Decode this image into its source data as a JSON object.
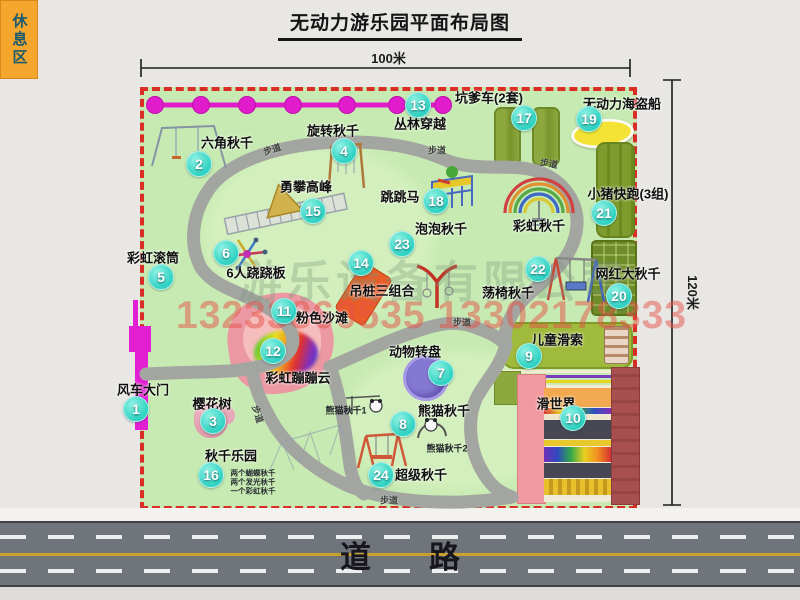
{
  "title": "无动力游乐园平面布局图",
  "dimensions": {
    "width_label": "100米",
    "height_label": "120米"
  },
  "road": {
    "label": "道路"
  },
  "watermark": {
    "company": "游乐设备有限公司",
    "phone": "13233860535 13302178333"
  },
  "rest_area": {
    "label": "休息区"
  },
  "walkway_label": "步道",
  "rainbow_swing_label": "彩虹秋千",
  "panda_sub_labels": [
    "熊猫秋千1",
    "熊猫秋千2"
  ],
  "swing_park_sublines": [
    "两个蝴蝶秋千",
    "两个发光秋千",
    "一个彩虹秋千"
  ],
  "attractions": [
    {
      "num": "1",
      "label": "风车大门",
      "bx": 135,
      "by": 408,
      "lx": 143,
      "ly": 389
    },
    {
      "num": "2",
      "label": "六角秋千",
      "bx": 198,
      "by": 163,
      "lx": 227,
      "ly": 142
    },
    {
      "num": "3",
      "label": "樱花树",
      "bx": 212,
      "by": 420,
      "lx": 212,
      "ly": 403
    },
    {
      "num": "4",
      "label": "旋转秋千",
      "bx": 343,
      "by": 150,
      "lx": 333,
      "ly": 130
    },
    {
      "num": "5",
      "label": "彩虹滚筒",
      "bx": 160,
      "by": 276,
      "lx": 153,
      "ly": 257
    },
    {
      "num": "6",
      "label": "6人跷跷板",
      "bx": 225,
      "by": 252,
      "lx": 256,
      "ly": 272
    },
    {
      "num": "7",
      "label": "动物转盘",
      "bx": 440,
      "by": 372,
      "lx": 415,
      "ly": 351
    },
    {
      "num": "8",
      "label": "熊猫秋千",
      "bx": 402,
      "by": 423,
      "lx": 444,
      "ly": 410
    },
    {
      "num": "9",
      "label": "儿童滑索",
      "bx": 528,
      "by": 355,
      "lx": 557,
      "ly": 339
    },
    {
      "num": "10",
      "label": "滑世界",
      "bx": 572,
      "by": 417,
      "lx": 556,
      "ly": 403
    },
    {
      "num": "11",
      "label": "粉色沙滩",
      "bx": 283,
      "by": 310,
      "lx": 322,
      "ly": 317
    },
    {
      "num": "12",
      "label": "彩虹蹦蹦云",
      "bx": 272,
      "by": 350,
      "lx": 298,
      "ly": 377
    },
    {
      "num": "13",
      "label": "丛林穿越",
      "bx": 417,
      "by": 104,
      "lx": 420,
      "ly": 123
    },
    {
      "num": "14",
      "label": "吊桩三组合",
      "bx": 360,
      "by": 262,
      "lx": 382,
      "ly": 290
    },
    {
      "num": "15",
      "label": "勇攀高峰",
      "bx": 312,
      "by": 210,
      "lx": 306,
      "ly": 186
    },
    {
      "num": "16",
      "label": "秋千乐园",
      "bx": 210,
      "by": 474,
      "lx": 231,
      "ly": 455
    },
    {
      "num": "17",
      "label": "坑爹车(2套)",
      "bx": 523,
      "by": 117,
      "lx": 489,
      "ly": 97
    },
    {
      "num": "18",
      "label": "跳跳马",
      "bx": 435,
      "by": 200,
      "lx": 400,
      "ly": 196
    },
    {
      "num": "19",
      "label": "无动力海盗船",
      "bx": 588,
      "by": 118,
      "lx": 622,
      "ly": 103
    },
    {
      "num": "20",
      "label": "网红大秋千",
      "bx": 618,
      "by": 295,
      "lx": 628,
      "ly": 273
    },
    {
      "num": "21",
      "label": "小猪快跑(3组)",
      "bx": 603,
      "by": 212,
      "lx": 628,
      "ly": 193
    },
    {
      "num": "22",
      "label": "荡椅秋千",
      "bx": 537,
      "by": 268,
      "lx": 508,
      "ly": 292
    },
    {
      "num": "23",
      "label": "泡泡秋千",
      "bx": 401,
      "by": 243,
      "lx": 441,
      "ly": 228
    },
    {
      "num": "24",
      "label": "超级秋千",
      "bx": 380,
      "by": 474,
      "lx": 421,
      "ly": 474
    }
  ]
}
